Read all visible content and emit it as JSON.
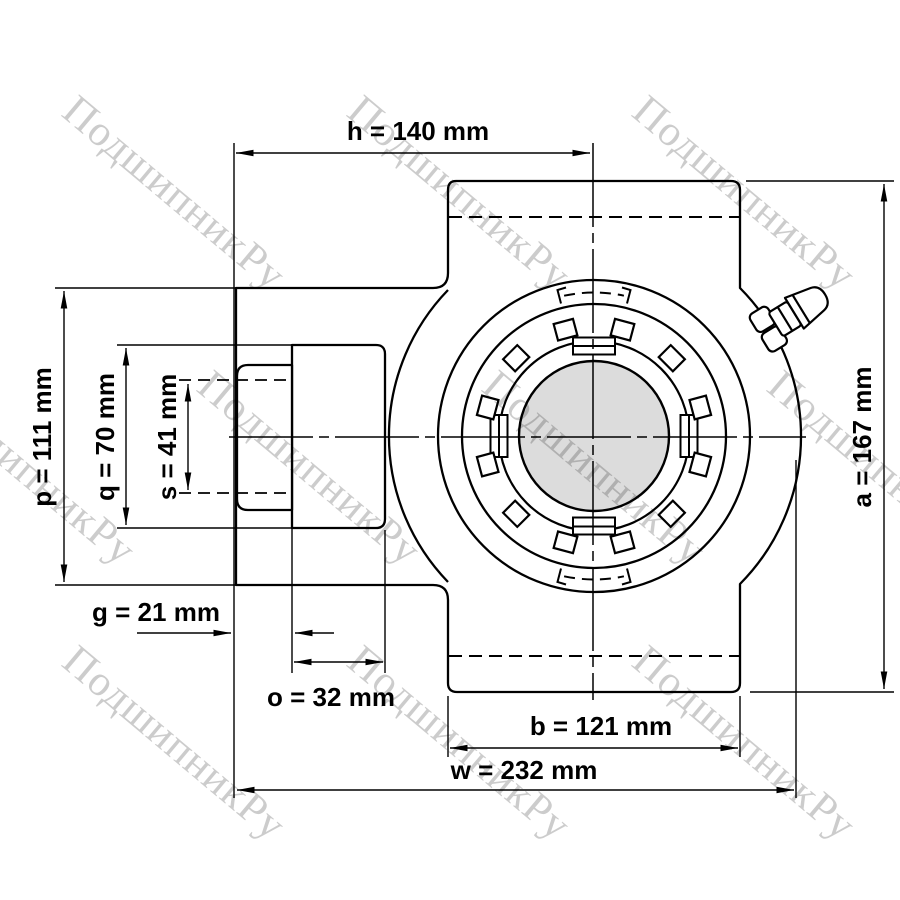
{
  "drawing": {
    "kind": "technical dimension drawing",
    "units": "mm"
  },
  "dimensions": {
    "h": {
      "label": "h = 140 mm",
      "letter": "h",
      "value": 140,
      "unit": "mm"
    },
    "p": {
      "label": "p = 111 mm",
      "letter": "p",
      "value": 111,
      "unit": "mm"
    },
    "q": {
      "label": "q = 70 mm",
      "letter": "q",
      "value": 70,
      "unit": "mm"
    },
    "s": {
      "label": "s = 41 mm",
      "letter": "s",
      "value": 41,
      "unit": "mm"
    },
    "g": {
      "label": "g = 21 mm",
      "letter": "g",
      "value": 21,
      "unit": "mm"
    },
    "o": {
      "label": "o = 32 mm",
      "letter": "o",
      "value": 32,
      "unit": "mm"
    },
    "b": {
      "label": "b = 121 mm",
      "letter": "b",
      "value": 121,
      "unit": "mm"
    },
    "w": {
      "label": "w = 232 mm",
      "letter": "w",
      "value": 232,
      "unit": "mm"
    },
    "a": {
      "label": "a = 167 mm",
      "letter": "a",
      "value": 167,
      "unit": "mm"
    }
  },
  "watermark": {
    "text": "ПодшипникРу"
  },
  "colors": {
    "line": "#000000",
    "shaft_fill": "#dcdcdc",
    "background": "#ffffff"
  }
}
